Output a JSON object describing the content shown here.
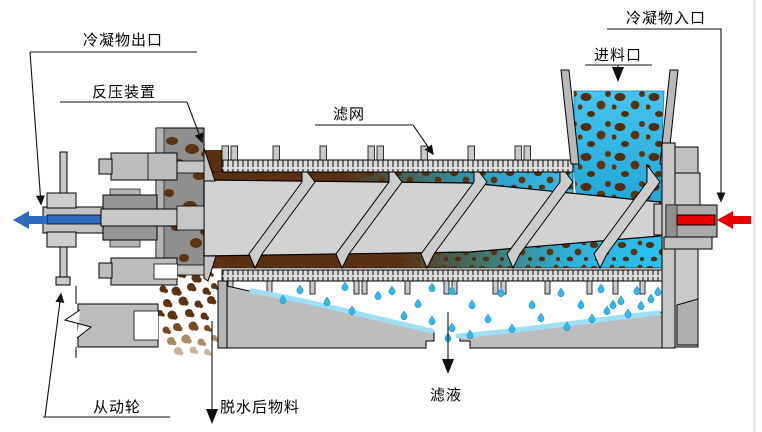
{
  "diagram": {
    "title": "screw-press-dewatering-machine-diagram",
    "labels": {
      "condensate_outlet": "冷凝物出口",
      "back_pressure_device": "反压装置",
      "filter_mesh": "滤网",
      "feed_inlet": "进料口",
      "condensate_inlet": "冷凝物入口",
      "driven_wheel": "从动轮",
      "dewatered_material": "脱水后物料",
      "filtrate": "滤液"
    },
    "colors": {
      "condensate_outlet_arrow": "#2e6bbf",
      "condensate_inlet_arrow": "#e60000",
      "slurry_cyan": "#38bce8",
      "solids_brown": "#5b2f11",
      "machine_gray": "#c9c9c9"
    }
  }
}
